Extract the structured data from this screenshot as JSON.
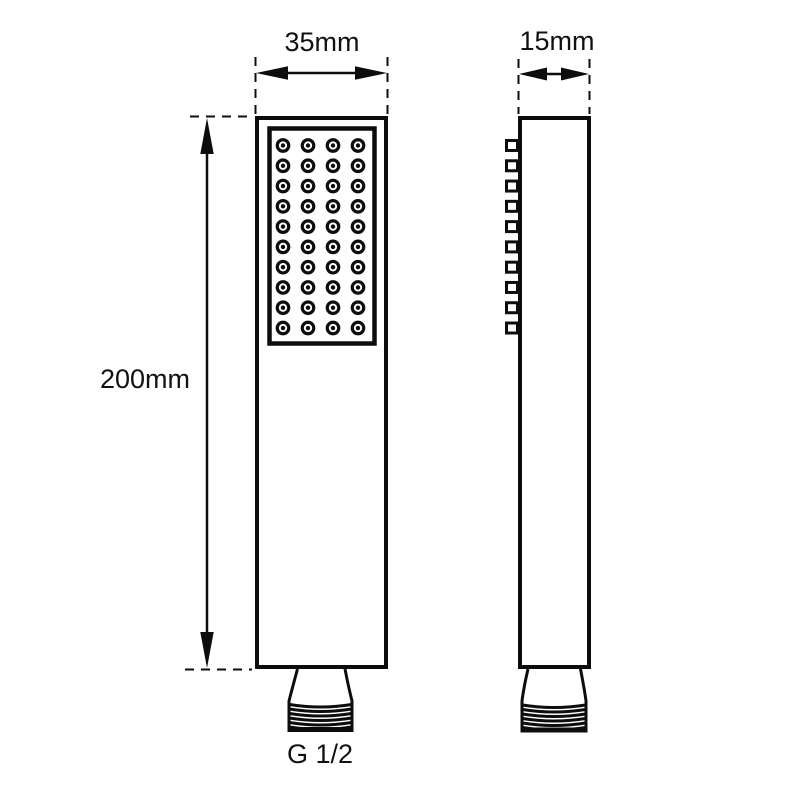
{
  "drawing": {
    "type": "technical-dimension-drawing",
    "subject": "square handheld shower head, front and side orthographic views",
    "background_color": "#ffffff",
    "line_color": "#0d0d0d",
    "labels": {
      "width_front": "35mm",
      "depth_side": "15mm",
      "height": "200mm",
      "thread": "G 1/2"
    },
    "front_view": {
      "nozzle_rows": 10,
      "nozzle_cols": 4,
      "nozzle_total": 40
    },
    "side_view": {
      "nozzle_profile_count": 10
    },
    "connector": {
      "thread_line_count": 6
    }
  }
}
